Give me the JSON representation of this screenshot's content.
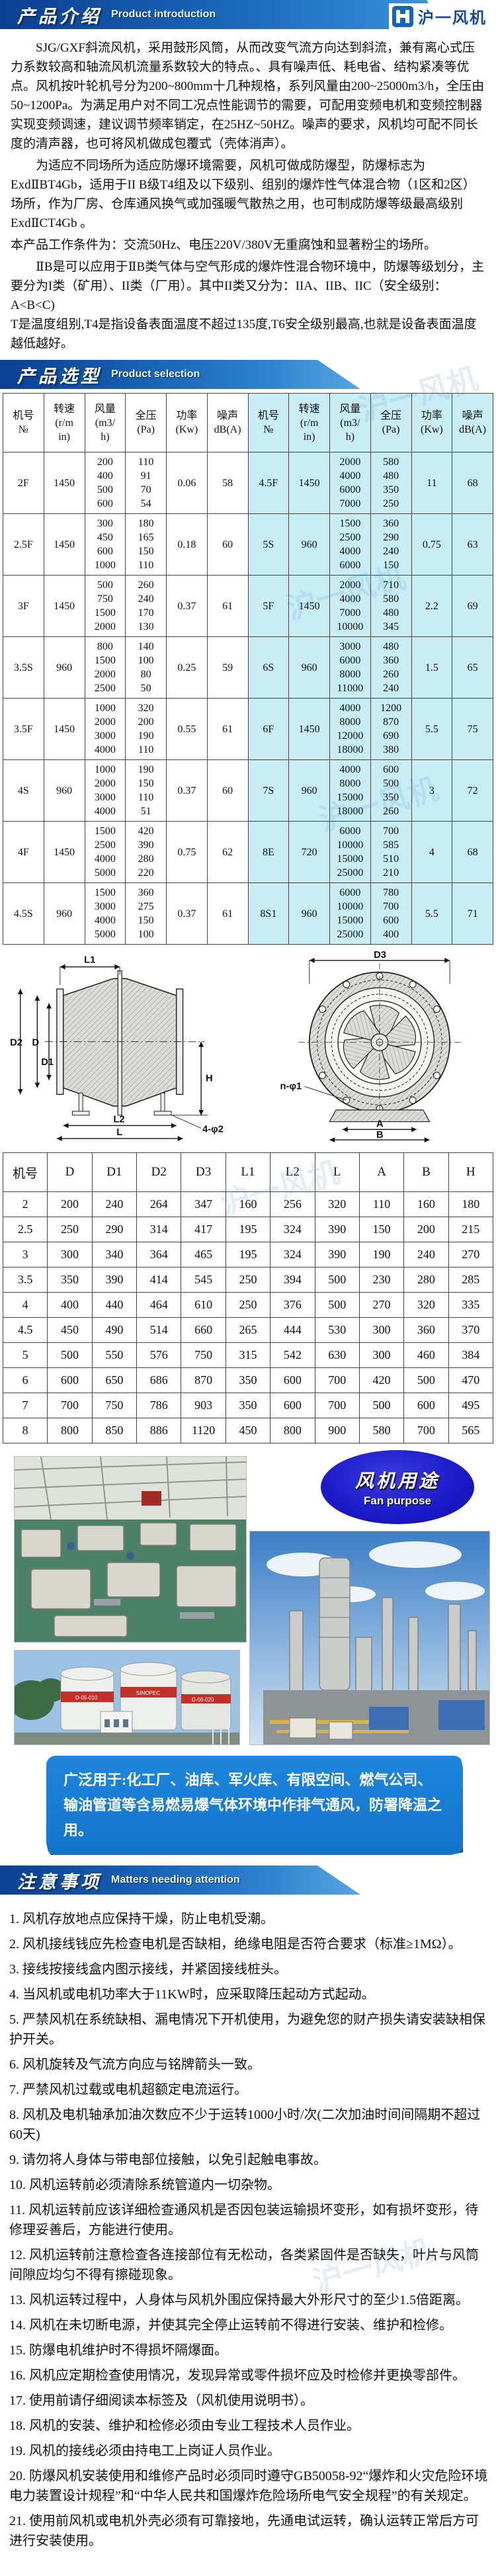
{
  "header": {
    "banner_title": "产品介绍",
    "banner_subtitle": "Product introduction",
    "logo_text": "沪一风机"
  },
  "intro": {
    "paragraphs": [
      "SJG/GXF斜流风机，采用鼓形风筒，从而改变气流方向达到斜流，兼有离心式压力系数较高和轴流风机流量系数较大的特点。、具有噪声低、耗电省、结构紧凑等优点。风机按叶轮机号分为200~800mm十几种规格，系列风量由200~25000m3/h，全压由50~1200Pa。为满足用户对不同工况点性能调节的需要，可配用变频电机和变频控制器实现变频调速，建议调节频率销定，在25HZ~50HZ。噪声的要求，风机均可配不同长度的清声器，也可将风机做成包覆式（壳体消声）。",
      "为适应不同场所为适应防爆环境需要，风机可做成防爆型，防爆标志为ExdⅡBT4Gb，适用于II B级T4组及以下级别、组别的爆炸性气体混合物（1区和2区）场所，作为厂房、仓库通风换气或加强暖气散热之用，也可制成防爆等级最高级别ExdⅡCT4Gb 。",
      "本产品工作条件为：交流50Hz、电压220V/380V无重腐蚀和显著粉尘的场所。",
      "ⅡB是可以应用于ⅡB类气体与空气形成的爆炸性混合物环境中，防爆等级划分，主要分为I类（矿用）、II类（厂用）。其中II类又分为：IIA、IIB、IIC（安全级别：A<B<C)\nT是温度组别,T4是指设备表面温度不超过135度,T6安全级别最高,也就是设备表面温度越低越好。"
    ]
  },
  "selection": {
    "banner_title": "产品选型",
    "banner_subtitle": "Product selection",
    "table": {
      "headers": [
        "机号\n№",
        "转速\n(r/m\nin)",
        "风量\n(m3/\nh)",
        "全压\n(Pa)",
        "功率\n(Kw)",
        "噪声\ndB(A)"
      ],
      "rows": [
        {
          "left": {
            "model": "2F",
            "speed": "1450",
            "flow": [
              "200",
              "400",
              "500",
              "600"
            ],
            "pressure": [
              "110",
              "91",
              "70",
              "54"
            ],
            "power": "0.06",
            "noise": "58"
          },
          "right": {
            "model": "4.5F",
            "speed": "1450",
            "flow": [
              "2000",
              "4000",
              "6000",
              "7000"
            ],
            "pressure": [
              "580",
              "480",
              "350",
              "250"
            ],
            "power": "11",
            "noise": "68"
          }
        },
        {
          "left": {
            "model": "2.5F",
            "speed": "1450",
            "flow": [
              "300",
              "450",
              "600",
              "1000"
            ],
            "pressure": [
              "180",
              "165",
              "150",
              "110"
            ],
            "power": "0.18",
            "noise": "60"
          },
          "right": {
            "model": "5S",
            "speed": "960",
            "flow": [
              "1500",
              "2500",
              "4000",
              "6000"
            ],
            "pressure": [
              "360",
              "290",
              "240",
              "150"
            ],
            "power": "0.75",
            "noise": "63"
          }
        },
        {
          "left": {
            "model": "3F",
            "speed": "1450",
            "flow": [
              "500",
              "750",
              "1500",
              "2000"
            ],
            "pressure": [
              "260",
              "240",
              "170",
              "130"
            ],
            "power": "0.37",
            "noise": "61"
          },
          "right": {
            "model": "5F",
            "speed": "1450",
            "flow": [
              "2000",
              "4000",
              "7000",
              "10000"
            ],
            "pressure": [
              "710",
              "580",
              "480",
              "345"
            ],
            "power": "2.2",
            "noise": "69"
          }
        },
        {
          "left": {
            "model": "3.5S",
            "speed": "960",
            "flow": [
              "800",
              "1500",
              "2000",
              "2500"
            ],
            "pressure": [
              "140",
              "100",
              "80",
              "50"
            ],
            "power": "0.25",
            "noise": "59"
          },
          "right": {
            "model": "6S",
            "speed": "960",
            "flow": [
              "3000",
              "6000",
              "8000",
              "11000"
            ],
            "pressure": [
              "480",
              "360",
              "260",
              "240"
            ],
            "power": "1.5",
            "noise": "65"
          }
        },
        {
          "left": {
            "model": "3.5F",
            "speed": "1450",
            "flow": [
              "1000",
              "2000",
              "3000",
              "4000"
            ],
            "pressure": [
              "320",
              "200",
              "190",
              "110"
            ],
            "power": "0.55",
            "noise": "61"
          },
          "right": {
            "model": "6F",
            "speed": "1450",
            "flow": [
              "4000",
              "8000",
              "12000",
              "18000"
            ],
            "pressure": [
              "1200",
              "870",
              "690",
              "380"
            ],
            "power": "5.5",
            "noise": "75"
          }
        },
        {
          "left": {
            "model": "4S",
            "speed": "960",
            "flow": [
              "1000",
              "2000",
              "3000",
              "4000"
            ],
            "pressure": [
              "190",
              "150",
              "110",
              "51"
            ],
            "power": "0.37",
            "noise": "60"
          },
          "right": {
            "model": "7S",
            "speed": "960",
            "flow": [
              "4000",
              "8000",
              "15000",
              "18000"
            ],
            "pressure": [
              "600",
              "500",
              "350",
              "260"
            ],
            "power": "3",
            "noise": "72"
          }
        },
        {
          "left": {
            "model": "4F",
            "speed": "1450",
            "flow": [
              "1500",
              "2500",
              "4000",
              "5000"
            ],
            "pressure": [
              "420",
              "390",
              "280",
              "220"
            ],
            "power": "0.75",
            "noise": "62"
          },
          "right": {
            "model": "8E",
            "speed": "720",
            "flow": [
              "6000",
              "10000",
              "15000",
              "25000"
            ],
            "pressure": [
              "700",
              "585",
              "510",
              "210"
            ],
            "power": "4",
            "noise": "68"
          }
        },
        {
          "left": {
            "model": "4.5S",
            "speed": "960",
            "flow": [
              "1500",
              "3000",
              "4000",
              "5000"
            ],
            "pressure": [
              "360",
              "275",
              "150",
              "100"
            ],
            "power": "0.37",
            "noise": "61"
          },
          "right": {
            "model": "8S1",
            "speed": "960",
            "flow": [
              "6000",
              "10000",
              "15000",
              "25000"
            ],
            "pressure": [
              "780",
              "700",
              "600",
              "400"
            ],
            "power": "5.5",
            "noise": "71"
          }
        }
      ]
    }
  },
  "dimensions": {
    "diagram": {
      "l1": "L1",
      "d2": "D2",
      "d": "D",
      "d1": "D1",
      "h": "H",
      "l2": "L2",
      "l": "L",
      "foot": "4-φ2",
      "d3": "D3",
      "nphi": "n-φ1",
      "a": "A",
      "b": "B"
    },
    "headers": [
      "机号",
      "D",
      "D1",
      "D2",
      "D3",
      "L1",
      "L2",
      "L",
      "A",
      "B",
      "H"
    ],
    "rows": [
      [
        "2",
        "200",
        "240",
        "264",
        "347",
        "160",
        "256",
        "320",
        "110",
        "160",
        "180"
      ],
      [
        "2.5",
        "250",
        "290",
        "314",
        "417",
        "195",
        "324",
        "390",
        "150",
        "200",
        "215"
      ],
      [
        "3",
        "300",
        "340",
        "364",
        "465",
        "195",
        "324",
        "390",
        "190",
        "240",
        "270"
      ],
      [
        "3.5",
        "350",
        "390",
        "414",
        "545",
        "250",
        "394",
        "500",
        "230",
        "280",
        "285"
      ],
      [
        "4",
        "400",
        "440",
        "464",
        "610",
        "250",
        "376",
        "500",
        "270",
        "320",
        "335"
      ],
      [
        "4.5",
        "450",
        "490",
        "514",
        "660",
        "265",
        "444",
        "530",
        "300",
        "360",
        "370"
      ],
      [
        "5",
        "500",
        "550",
        "576",
        "750",
        "315",
        "542",
        "630",
        "300",
        "460",
        "384"
      ],
      [
        "6",
        "600",
        "650",
        "686",
        "870",
        "350",
        "600",
        "700",
        "420",
        "500",
        "470"
      ],
      [
        "7",
        "700",
        "750",
        "786",
        "903",
        "350",
        "600",
        "700",
        "500",
        "600",
        "495"
      ],
      [
        "8",
        "800",
        "850",
        "886",
        "1120",
        "450",
        "800",
        "900",
        "580",
        "700",
        "565"
      ]
    ]
  },
  "purpose": {
    "badge_title": "风机用途",
    "badge_subtitle": "Fan purpose",
    "photos": [
      "factory-workshop",
      "chemical-plant",
      "oil-storage-tanks"
    ],
    "banner_text": "广泛用于:化工厂、油库、军火库、有限空间、燃气公司、输油管道等含易燃易爆气体环境中作排气通风，防署降温之用。"
  },
  "attention": {
    "banner_title": "注意事项",
    "banner_subtitle": "Matters needing attention",
    "items": [
      "1. 风机存放地点应保持干燥，防止电机受潮。",
      "2. 风机接线钱应先检查电机是否缺相，绝缘电阻是否符合要求（标准≥1MΩ）。",
      "3. 接线按接线盒内图示接线，并紧固接线桩头。",
      "4. 当风机或电机功率大于11KW时，应采取降压起动方式起动。",
      "5. 严禁风机在系统缺相、漏电情况下开机使用，为避免您的财产损失请安装缺相保护开关。",
      "6. 风机旋转及气流方向应与铭牌箭头一致。",
      "7. 严禁风机过载或电机超额定电流运行。",
      "8. 风机及电机轴承加油次数应不少于运转1000小时/次(二次加油时间间隔期不超过60天)",
      "9. 请勿将人身体与带电部位接触，以免引起触电事故。",
      "10. 风机运转前必须清除系统管道内一切杂物。",
      "11. 风机运转前应该详细检查通风机是否因包装运输损坏变形，如有损坏变形，待修理妥善后，方能进行使用。",
      "12. 风机运转前注意检查各连接部位有无松动，各类紧固件是否缺失，叶片与风筒间隙应均匀不得有擦碰现象。",
      "13. 风机运转过程中，人身体与风机外围应保持最大外形尺寸的至少1.5倍距离。",
      "14. 风机在未切断电源，并使其完全停止运转前不得进行安装、维护和检修。",
      "15. 防爆电机维护时不得损坏隔爆面。",
      "16. 风机应定期检查使用情况，发现异常或零件损坏应及时检修并更换零部件。",
      "17. 使用前请仔细阅读本标签及（风机使用说明书）。",
      "18. 风机的安装、维护和检修必须由专业工程技术人员作业。",
      "19. 风机的接线必须由持电工上岗证人员作业。",
      "20. 防爆风机安装使用和维修产品时必须同时遵守GB50058-92“爆炸和火灾危险环境电力装置设计规程”和“中华人民共和国爆炸危险场所电气安全规程”的有关规定。",
      "21. 使用前风机或电机外壳必须有可靠接地，先通电试运转，确认运转正常后方可进行安装使用。"
    ]
  },
  "colors": {
    "ribbon_blue_dark": "#0b3f92",
    "ribbon_blue_light": "#59a5e2",
    "table_right_bg": "#c8edf5",
    "badge_blue": "#1c1ccb",
    "app_banner_blue": "#1373cb"
  }
}
